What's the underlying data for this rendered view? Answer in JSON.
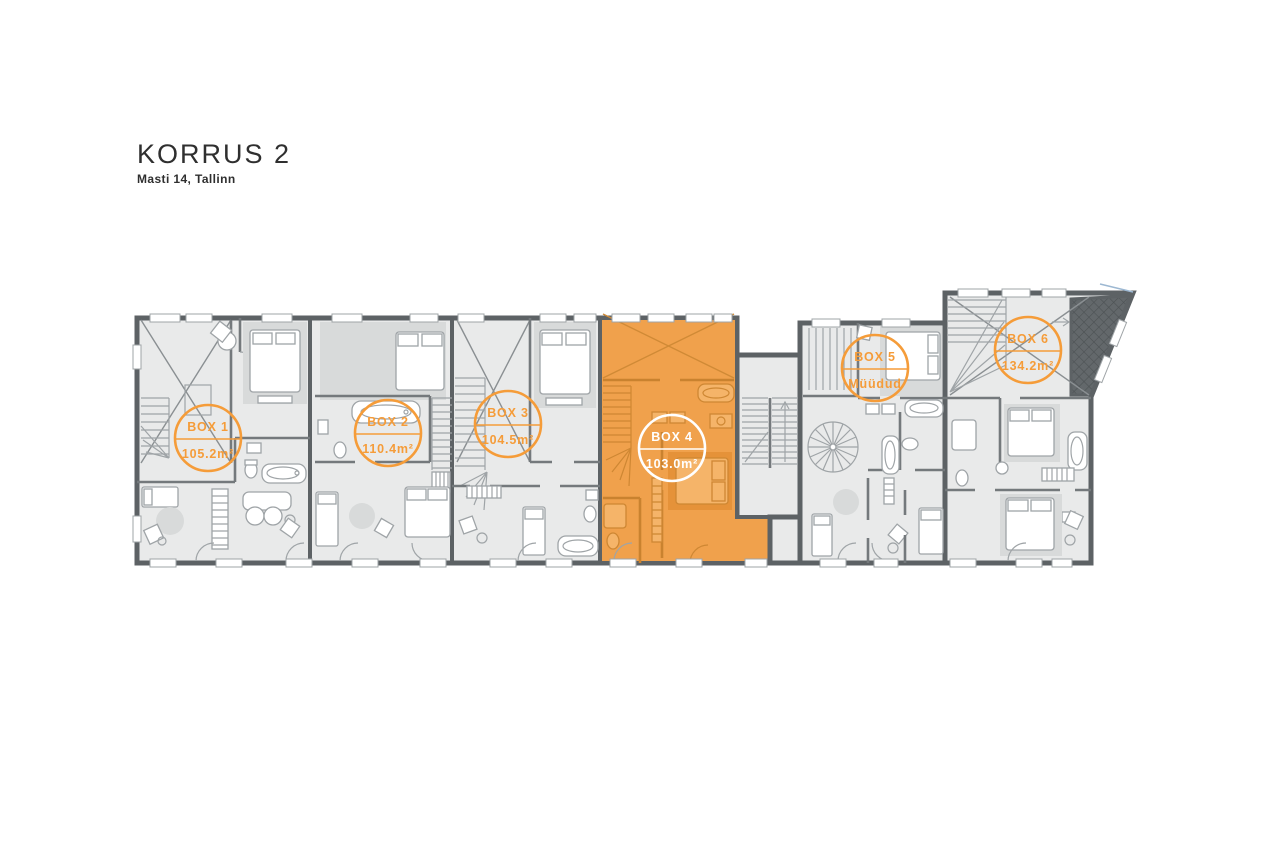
{
  "page": {
    "title": "KORRUS 2",
    "subtitle": "Masti 14, Tallinn"
  },
  "palette": {
    "highlight_fill": "#F0A14C",
    "label_orange": "#F59C39",
    "wall_gray": "#5D6265",
    "room_fill": "#E9EAEA",
    "terrace_hatch": "#63686B"
  },
  "units": [
    {
      "name": "BOX 1",
      "detail": "105.2m²",
      "highlighted": false
    },
    {
      "name": "BOX 2",
      "detail": "110.4m²",
      "highlighted": false
    },
    {
      "name": "BOX 3",
      "detail": "104.5m²",
      "highlighted": false
    },
    {
      "name": "BOX 4",
      "detail": "103.0m²",
      "highlighted": true
    },
    {
      "name": "BOX 5",
      "detail": "Müüdud",
      "highlighted": false
    },
    {
      "name": "BOX 6",
      "detail": "134.2m²",
      "highlighted": false
    }
  ]
}
